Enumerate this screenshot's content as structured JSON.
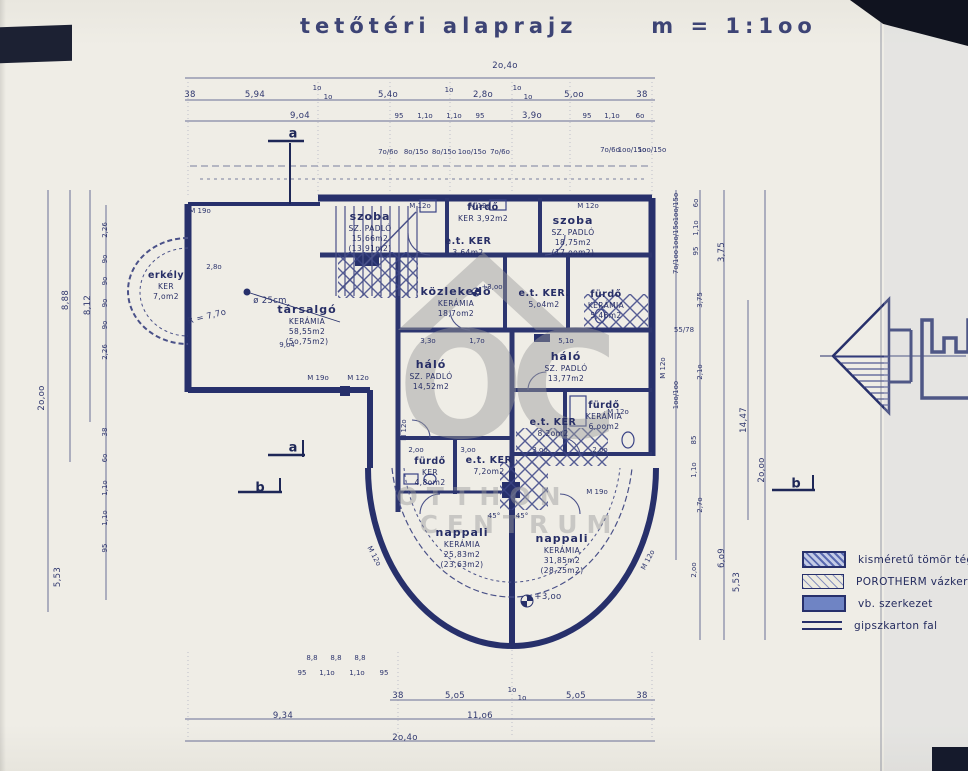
{
  "title": "tetőtéri alaprajz      m = 1:1oo",
  "watermark": {
    "logo": "OC",
    "name_line1": "OTTHON",
    "name_line2": "CENTRUM"
  },
  "colors": {
    "ink": "#27306b",
    "paper": "#edebe4",
    "watermark": "#9b9b9b",
    "wall_fill": "#6f84c4"
  },
  "legend": {
    "items": [
      {
        "label": "kisméretű tömör tégla",
        "swatch": "hatch-dense-brick"
      },
      {
        "label": "POROTHERM vázkerámia",
        "swatch": "hatch-light"
      },
      {
        "label": "vb. szerkezet",
        "swatch": "solid-blue"
      },
      {
        "label": "gipszkarton fal",
        "swatch": "double-line"
      }
    ]
  },
  "rooms": [
    {
      "name": "szoba",
      "l1": "SZ. PADLÓ",
      "l2": "15,66m2",
      "l3": "(13,91m2)"
    },
    {
      "name": "fürdő",
      "l1": "KER  3,92m2"
    },
    {
      "name": "e.t. KER",
      "l1": "3,64m2"
    },
    {
      "name": "szoba",
      "l1": "SZ. PADLÓ",
      "l2": "18,75m2",
      "l3": "(17,oom2)"
    },
    {
      "name": "erkély",
      "l1": "KER",
      "l2": "7,om2"
    },
    {
      "name": "társalgó",
      "l1": "KERÁMIA",
      "l2": "58,55m2",
      "l3": "(5o,75m2)"
    },
    {
      "name": "közlekedő",
      "l1": "KERÁMIA",
      "l2": "18,7om2"
    },
    {
      "name": "e.t. KER.",
      "l1": "5,o4m2"
    },
    {
      "name": "fürdő",
      "l1": "KERÁMIA",
      "l2": "5,46m2"
    },
    {
      "name": "háló",
      "l1": "SZ. PADLÓ",
      "l2": "14,52m2"
    },
    {
      "name": "háló",
      "l1": "SZ. PADLÓ",
      "l2": "13,77m2"
    },
    {
      "name": "fürdő",
      "l1": "KERÁMIA",
      "l2": "6,oom2"
    },
    {
      "name": "e.t. KER",
      "l1": "8,2om2"
    },
    {
      "name": "fürdő",
      "l1": "KER",
      "l2": "4,8om2"
    },
    {
      "name": "e.t. KER",
      "l1": "7,2om2"
    },
    {
      "name": "nappali",
      "l1": "KERÁMIA",
      "l2": "25,83m2",
      "l3": "(23,63m2)"
    },
    {
      "name": "nappali",
      "l1": "KERÁMIA",
      "l2": "31,85m2",
      "l3": "(28,25m2)"
    }
  ],
  "dims": {
    "top_total": "2o,4o",
    "top_row2": [
      "38",
      "5,94",
      "1o",
      "1o",
      "5,4o",
      "1o",
      "2,8o",
      "1o",
      "1o",
      "5,oo",
      "38"
    ],
    "top_row3": [
      "9,o4",
      "95",
      "1,1o",
      "1,1o",
      "95",
      "3,9o",
      "95",
      "1,1o",
      "6o"
    ],
    "bottom_row1": [
      "38",
      "5,o5",
      "1o",
      "1o",
      "5,o5",
      "38"
    ],
    "bottom_row2": [
      "9,34",
      "11,o6"
    ],
    "bottom_total": "2o,4o",
    "left_col": [
      "2o,oo",
      "8,88",
      "8,12",
      "5,53"
    ],
    "left_chain": [
      "2,26",
      "9o",
      "9o",
      "9o",
      "9o",
      "2,26"
    ],
    "left_chain2": [
      "38",
      "6o",
      "1,1o",
      "1,1o",
      "95"
    ],
    "right_col": [
      "2o,oo",
      "14,47",
      "3,75",
      "6,o9",
      "5,53"
    ],
    "right_chain": [
      "6o",
      "1,1o",
      "95",
      "3,75",
      "2,1o",
      "85",
      "1,1o",
      "2,7o",
      "2,oo"
    ],
    "right_pairs": [
      "1oo/15o",
      "1oo/15o",
      "7o/1oo",
      "55/78",
      "1oo/1oo"
    ],
    "top_pairs": [
      "7o/6o",
      "8o/15o",
      "8o/15o",
      "1oo/15o",
      "7o/6o",
      "7o/6o",
      "1oo/15o",
      "1oo/15o"
    ],
    "inner_chain": [
      "3,3o",
      "1,7o",
      "5,1o"
    ],
    "inner_chain2": [
      "2,oo",
      "3,oo",
      "3,oo",
      "2,oo"
    ],
    "arc_chain": [
      "95",
      "1,1o",
      "1,1o",
      "95"
    ],
    "small88": "8,8"
  },
  "marks": {
    "m19": "M 19o",
    "m12": "M 12o"
  },
  "annotations": {
    "radius": "R = 7,7o",
    "column": "ø 25cm",
    "dim280": "2,8o",
    "dim904": "9,o4",
    "level": "+3,oo",
    "deg45": "45°"
  },
  "sections": {
    "a": "a",
    "b": "b"
  }
}
